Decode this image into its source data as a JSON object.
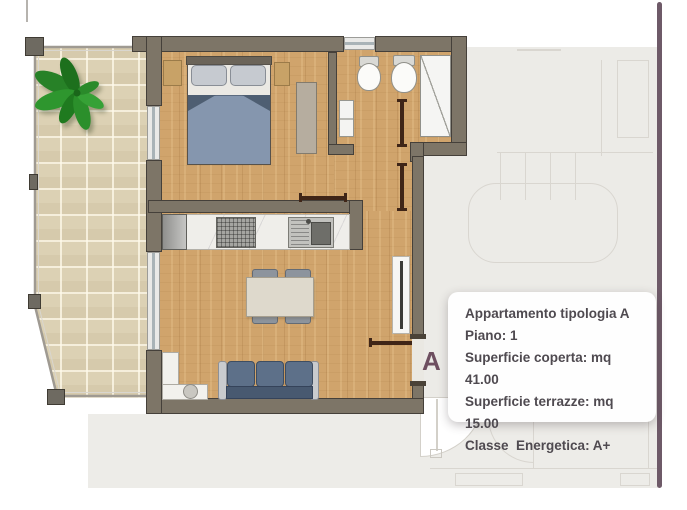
{
  "unit_label": "A",
  "info_box": {
    "title": "Appartamento tipologia A",
    "lines": [
      "Piano: 1",
      "Superficie coperta: mq 41.00",
      "Superficie terrazze: mq 15.00",
      "Classe  Energetica: A+"
    ]
  },
  "colors": {
    "wall": "#7d7567",
    "wood_floor": "#d0a46c",
    "terrace_tile": "#dcd1b4",
    "plant_green": "#2e962e",
    "duvet_blue": "#8596ae",
    "sofa_blue": "#5d7089",
    "accent_plum": "#6e4f60",
    "adjacent_plan": "#ecebe7",
    "info_text": "#4f4a50"
  }
}
